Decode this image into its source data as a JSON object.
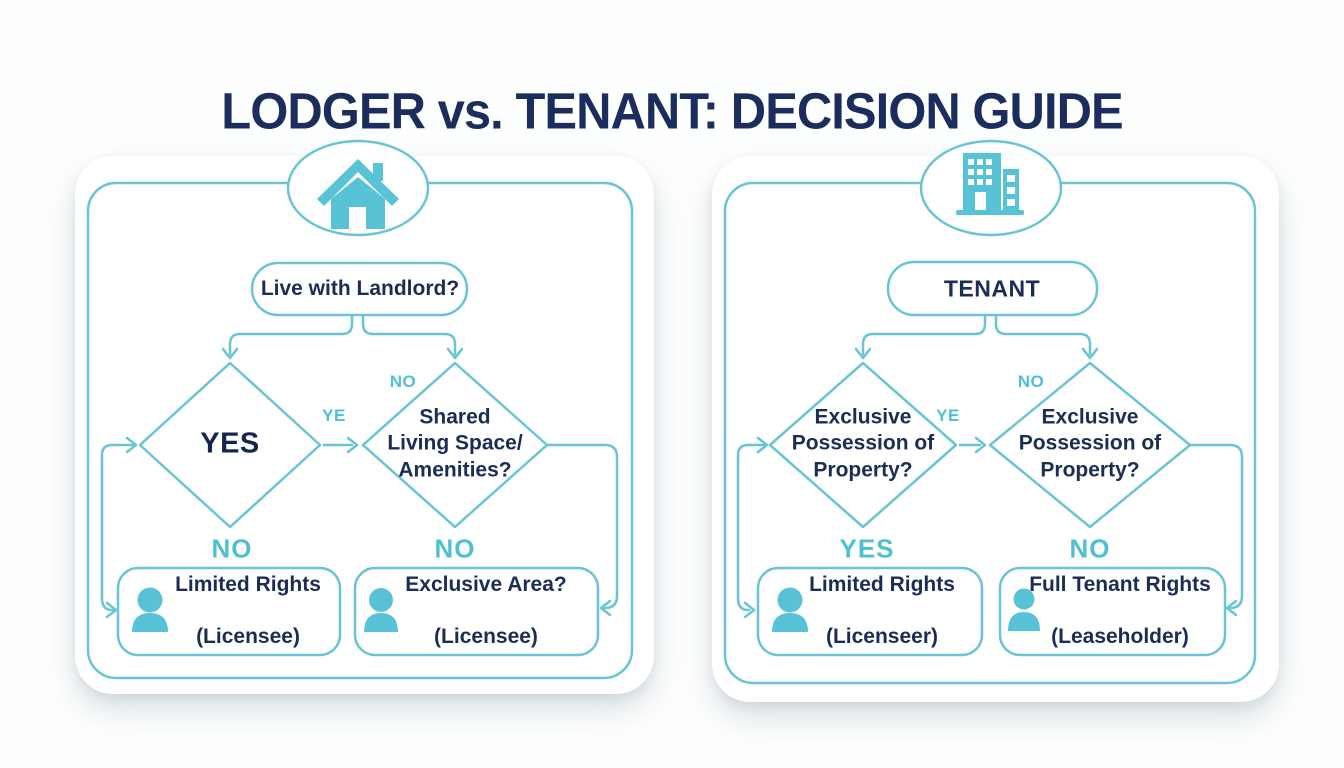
{
  "title": "LODGER vs. TENANT: DECISION GUIDE",
  "colors": {
    "navy_text": "#1b2c55",
    "teal_line": "#69c4d3",
    "teal_label": "#4fbfd4",
    "teal_fill": "#58c3d7",
    "card_bg": "#ffffff"
  },
  "left_panel": {
    "icon": "house-icon",
    "root_label": "Live with Landlord?",
    "diamond_left": "YES",
    "diamond_right": "Shared\nLiving Space/\nAmenities?",
    "label_yes_mid": "YE",
    "label_no_top": "NO",
    "label_below_left": "NO",
    "label_below_right": "NO",
    "result_left": {
      "title": "Limited Rights",
      "subtitle": "(Licensee)"
    },
    "result_right": {
      "title": "Exclusive Area?",
      "subtitle": "(Licensee)"
    }
  },
  "right_panel": {
    "icon": "building-icon",
    "root_label": "TENANT",
    "diamond_left": "Exclusive\nPossession of\nProperty?",
    "diamond_right": "Exclusive\nPossession of\nProperty?",
    "label_yes_mid": "YE",
    "label_no_top": "NO",
    "label_below_left": "YES",
    "label_below_right": "NO",
    "result_left": {
      "title": "Limited Rights",
      "subtitle": "(Licenseer)"
    },
    "result_right": {
      "title": "Full Tenant Rights",
      "subtitle": "(Leaseholder)"
    }
  }
}
